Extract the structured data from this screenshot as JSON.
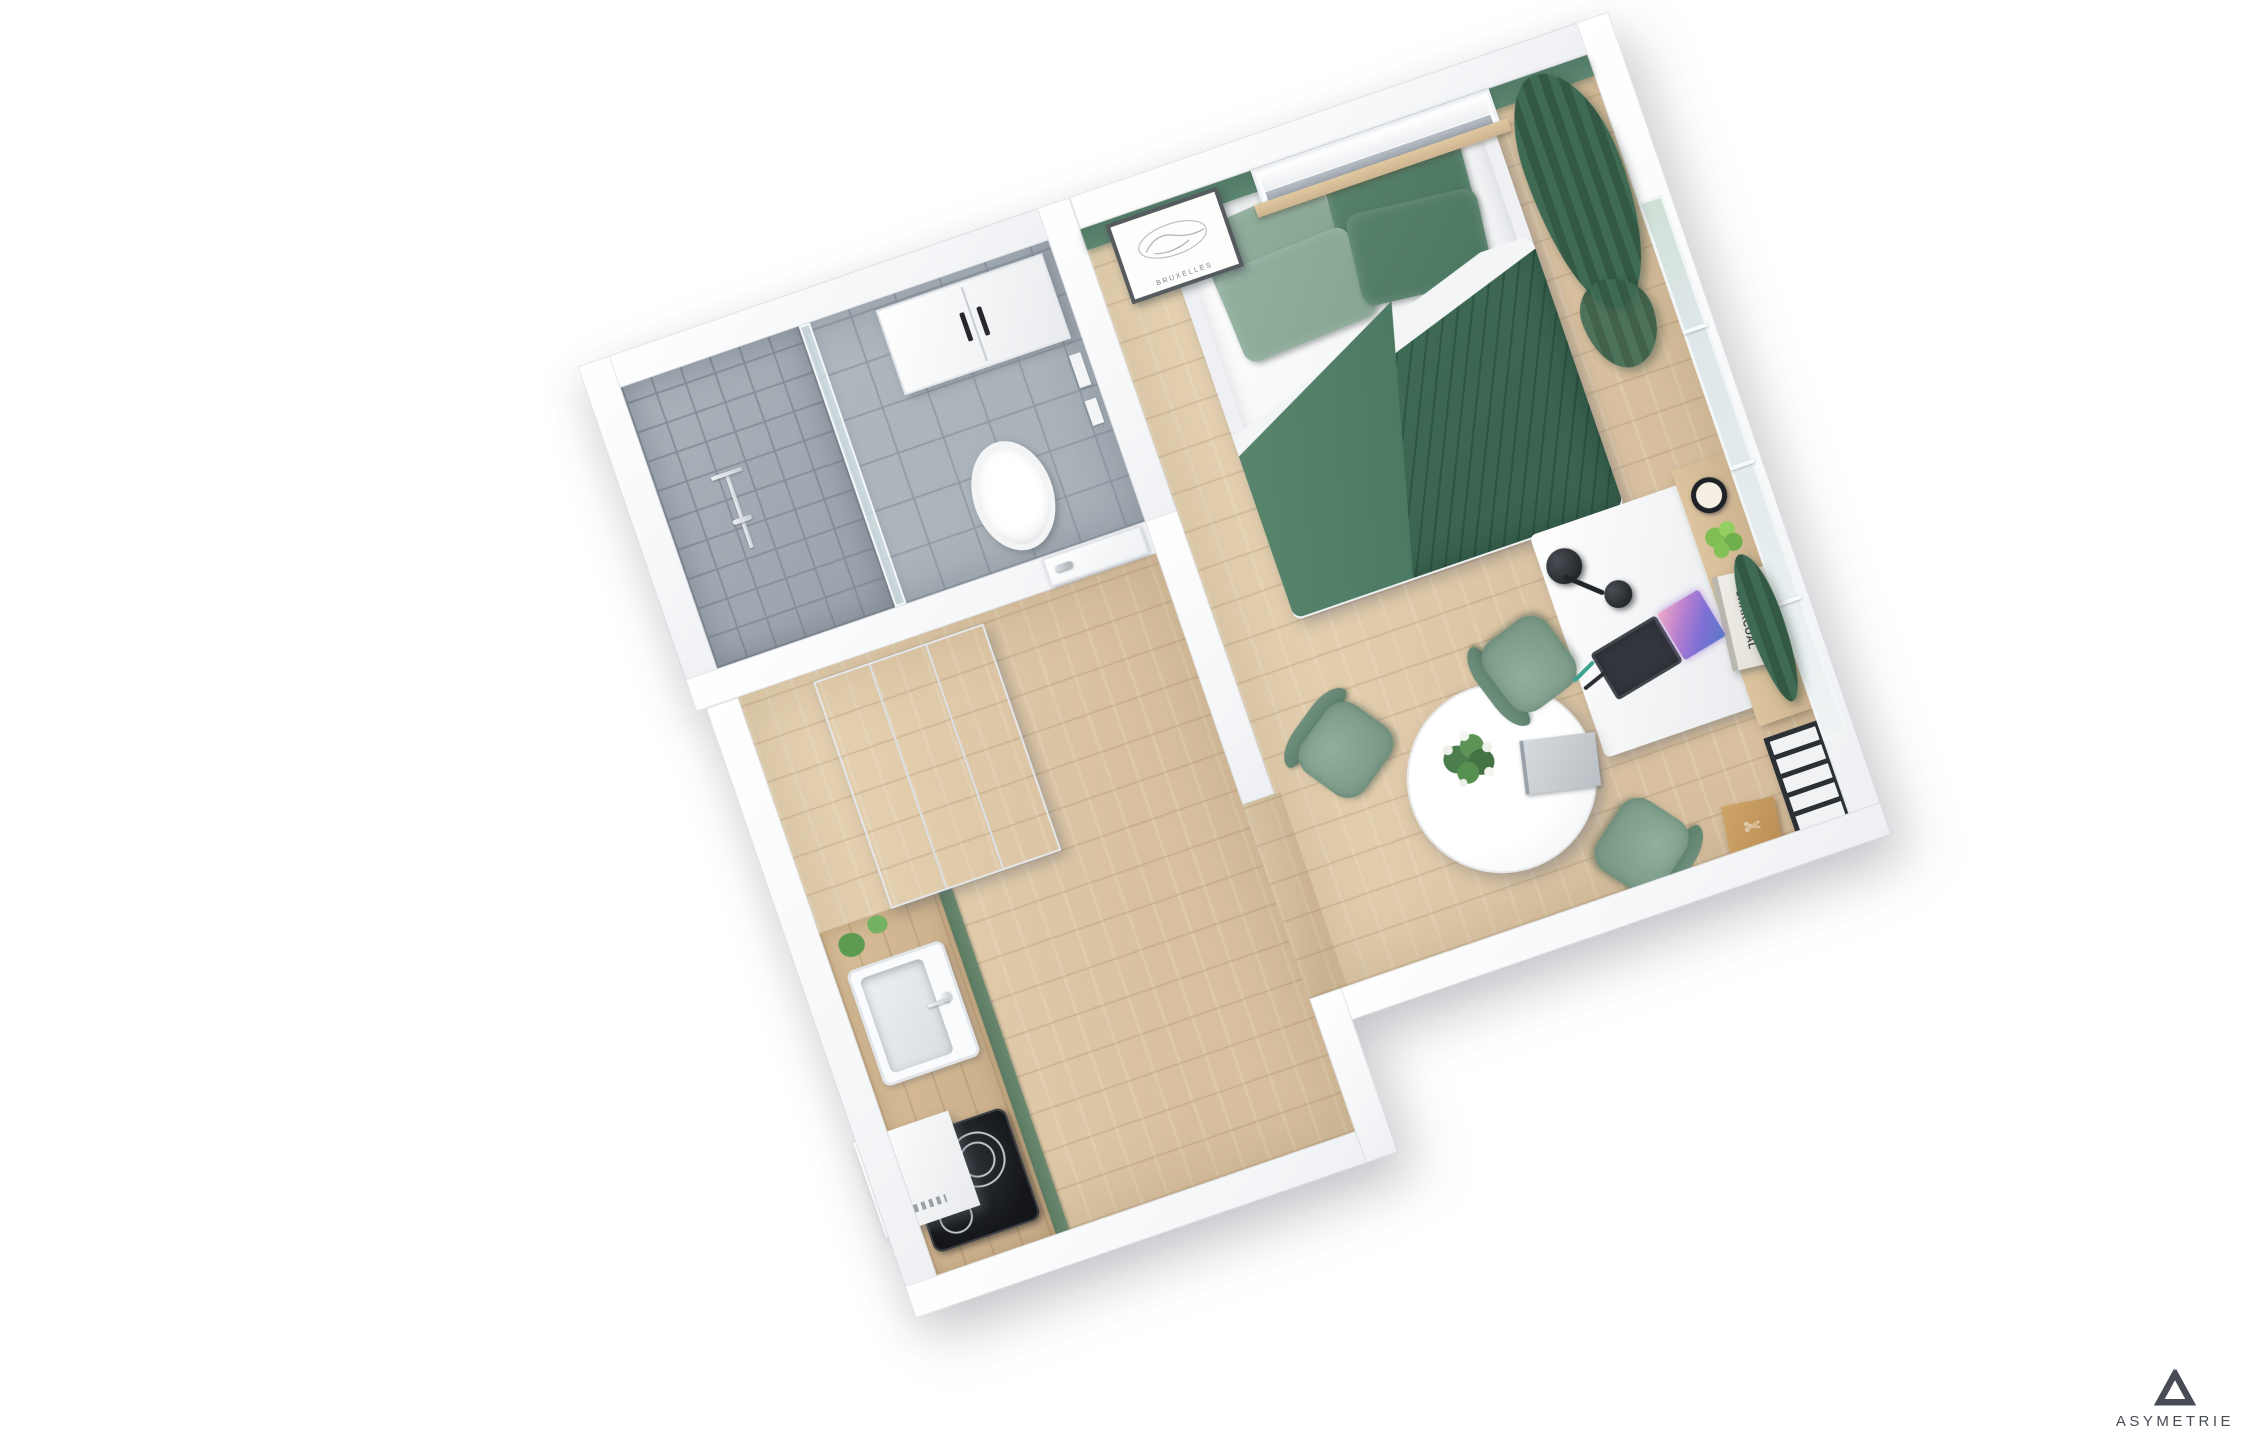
{
  "logo": {
    "brand": "ASYMETRIE",
    "icon": "penrose-triangle-icon"
  },
  "bedroom": {
    "artwork_caption": "BRUXELLES"
  },
  "desk": {
    "book_title_line1": "ROBERT",
    "book_title_line2": "LONGO",
    "book_title_line3": "CHARCOAL"
  },
  "colors": {
    "bg": "#ffffff",
    "wall_top": "#f6f7f9",
    "accent_wall": "#5d8671",
    "floor_wood": "#d8c09f",
    "counter_wood": "#c9ad8a",
    "tile": "#a7afb7",
    "curtain": "#3f6a53",
    "duvet": "#43705a",
    "pillow_sage": "#86a492",
    "pillow_dark": "#4b7660",
    "chair": "#7b9b88",
    "metal_dark": "#2c2f34",
    "logo": "#474b54"
  }
}
